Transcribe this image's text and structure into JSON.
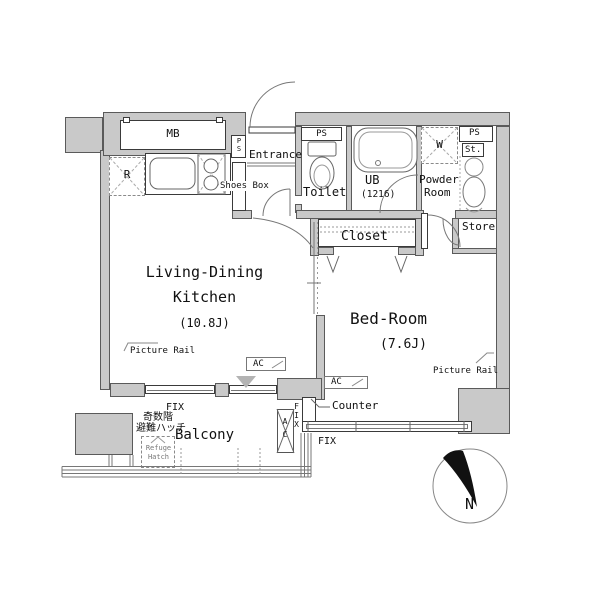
{
  "rooms": {
    "ldk": {
      "line1": "Living-Dining",
      "line2": "Kitchen",
      "area": "(10.8J)"
    },
    "bedroom": {
      "name": "Bed-Room",
      "area": "(7.6J)"
    },
    "entrance": {
      "name": "Entrance"
    },
    "toilet": {
      "name": "Toilet"
    },
    "bath": {
      "name": "UB",
      "size": "(1216)"
    },
    "powder": {
      "line1": "Powder",
      "line2": "Room"
    },
    "closet": {
      "name": "Closet"
    },
    "store": {
      "name": "Store"
    },
    "balcony": {
      "name": "Balcony"
    }
  },
  "labels": {
    "mb": "MB",
    "ps": "PS",
    "r": "R",
    "w": "W",
    "st": "St.",
    "shoes_box": "Shoes Box",
    "picture_rail": "Picture Rail",
    "ac": "AC",
    "counter": "Counter",
    "fix": "FIX",
    "refuge_floor_jp": "奇数階",
    "refuge_hatch_jp": "避難ハッチ",
    "refuge_hatch_en": "Refuge Hatch",
    "north": "N"
  },
  "colors": {
    "wall": "#c9c9c9",
    "line": "#444444",
    "text": "#111111"
  }
}
